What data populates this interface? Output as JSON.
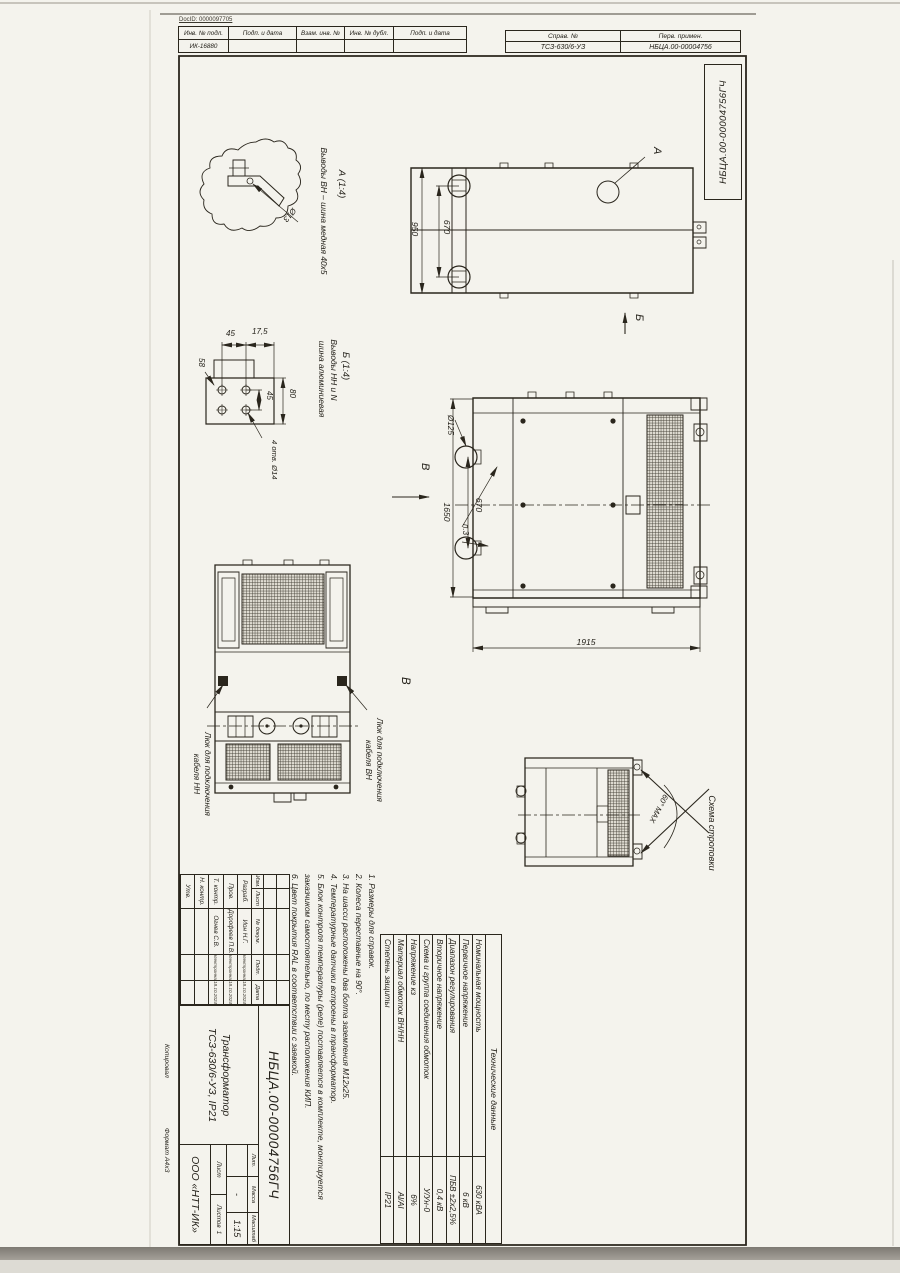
{
  "palette": {
    "ink": "#2a261d",
    "paper": "#f4f3ed"
  },
  "header": {
    "docid": "DocID: 0000097705",
    "inv_table": {
      "cols": [
        "Инв. № подл.",
        "Подп. и дата",
        "Взам. инв. №",
        "Инв. № дубл.",
        "Подп. и дата"
      ],
      "inv_no": "ИК-16880"
    },
    "ref_table": {
      "col1_label": "Справ. №",
      "col2_label": "Перв. примен.",
      "col1_value": "ТСЗ-630/6-УЗ",
      "col2_value": "НБЦА.00-00004756"
    },
    "corner_code": "НБЦА.00-00004756ГЧ"
  },
  "views": {
    "detail_a": {
      "title": "А (1:4)",
      "caption": "Выводы ВН – шина медная 40х5",
      "dim_hole": "Ø13"
    },
    "detail_b": {
      "title": "Б (1:4)",
      "caption_line1": "Выводы НН и N",
      "caption_line2": "шина алюминиевая",
      "dim_top1": "45",
      "dim_top2": "17,5",
      "dim_left": "58",
      "dim_right1": "45",
      "dim_right2": "80",
      "dim_holes": "4 отв. Ø14"
    },
    "top_view": {
      "dim_depth": "950",
      "dim_wheel_span": "670",
      "callout": "А",
      "view_arrow": "Б"
    },
    "front_view": {
      "dim_wheel_dia": "Ø125",
      "dim_wheel_span": "670",
      "dim_height": "1650",
      "dim_length": "1915",
      "note_ref": "п.3",
      "view_arrow": "В"
    },
    "bottom_view": {
      "title": "В",
      "hatch_nn_line1": "Люк для подключения",
      "hatch_nn_line2": "кабеля НН",
      "hatch_vn_line1": "Люк для подключения",
      "hatch_vn_line2": "кабеля ВН"
    },
    "sling_view": {
      "title": "Схема строповки",
      "angle": "60° MAX"
    }
  },
  "notes": [
    "1.  Размеры для справок.",
    "2.  Колеса переставные на 90°.",
    "3.  На шасси расположены два болта заземления М12х25.",
    "4.  Температурные датчики встроены в трансформатор.",
    "5.  Блок контроля температуры (реле) поставляется в комплекте, монтируется",
    "      заказчиком самостоятельно, по месту расположения КИП.",
    "6.  Цвет покрытия RAL в соответствии с заявкой."
  ],
  "tech_table": {
    "title": "Технические данные",
    "rows": [
      {
        "label": "Номинальная мощность",
        "value": "630 кВА"
      },
      {
        "label": "Первичное напряжение",
        "value": "6 кВ"
      },
      {
        "label": "Диапазон регулирования",
        "value": "ПБВ ±2х2,5%"
      },
      {
        "label": "Вторичное напряжение",
        "value": "0,4 кВ"
      },
      {
        "label": "Схема и группа соединения обмоток",
        "value": "У/Ун-0"
      },
      {
        "label": "Напряжение кз",
        "value": "6%"
      },
      {
        "label": "Материал обмоток ВН/НН",
        "value": "Al/Al"
      },
      {
        "label": "Степень защиты",
        "value": "IP21"
      }
    ]
  },
  "title_block": {
    "change_cols": [
      "Изм.",
      "Лист",
      "№ докум.",
      "Подп.",
      "Дата"
    ],
    "sign_rows": [
      {
        "role": "Разраб.",
        "name": "Ион Н.Г.",
        "sig": "Электронная",
        "date": "18.10.2024"
      },
      {
        "role": "Пров.",
        "name": "Дорофеев П.В.",
        "sig": "Электронная",
        "date": "18.10.2024"
      },
      {
        "role": "Т. контр.",
        "name": "Огнев С.В.",
        "sig": "Электронная",
        "date": "18.10.2024"
      },
      {
        "role": "Н. контр.",
        "name": "",
        "sig": "",
        "date": ""
      },
      {
        "role": "Утв.",
        "name": "",
        "sig": "",
        "date": ""
      }
    ],
    "designation": "НБЦА.00-00004756ГЧ",
    "product_line1": "Трансформатор",
    "product_line2": "ТСЗ-630/6-УЗ, IP21",
    "lit_label": "Лит.",
    "mass_label": "Масса",
    "scale_label": "Масштаб",
    "mass_value": "-",
    "scale_value": "1:15",
    "sheet_label": "Лист",
    "sheets_label": "Листов",
    "sheets_value": "1",
    "org": "ООО «НТТ-ИК»"
  },
  "margins": {
    "copied": "Копировал",
    "format": "Формат А4х3"
  }
}
